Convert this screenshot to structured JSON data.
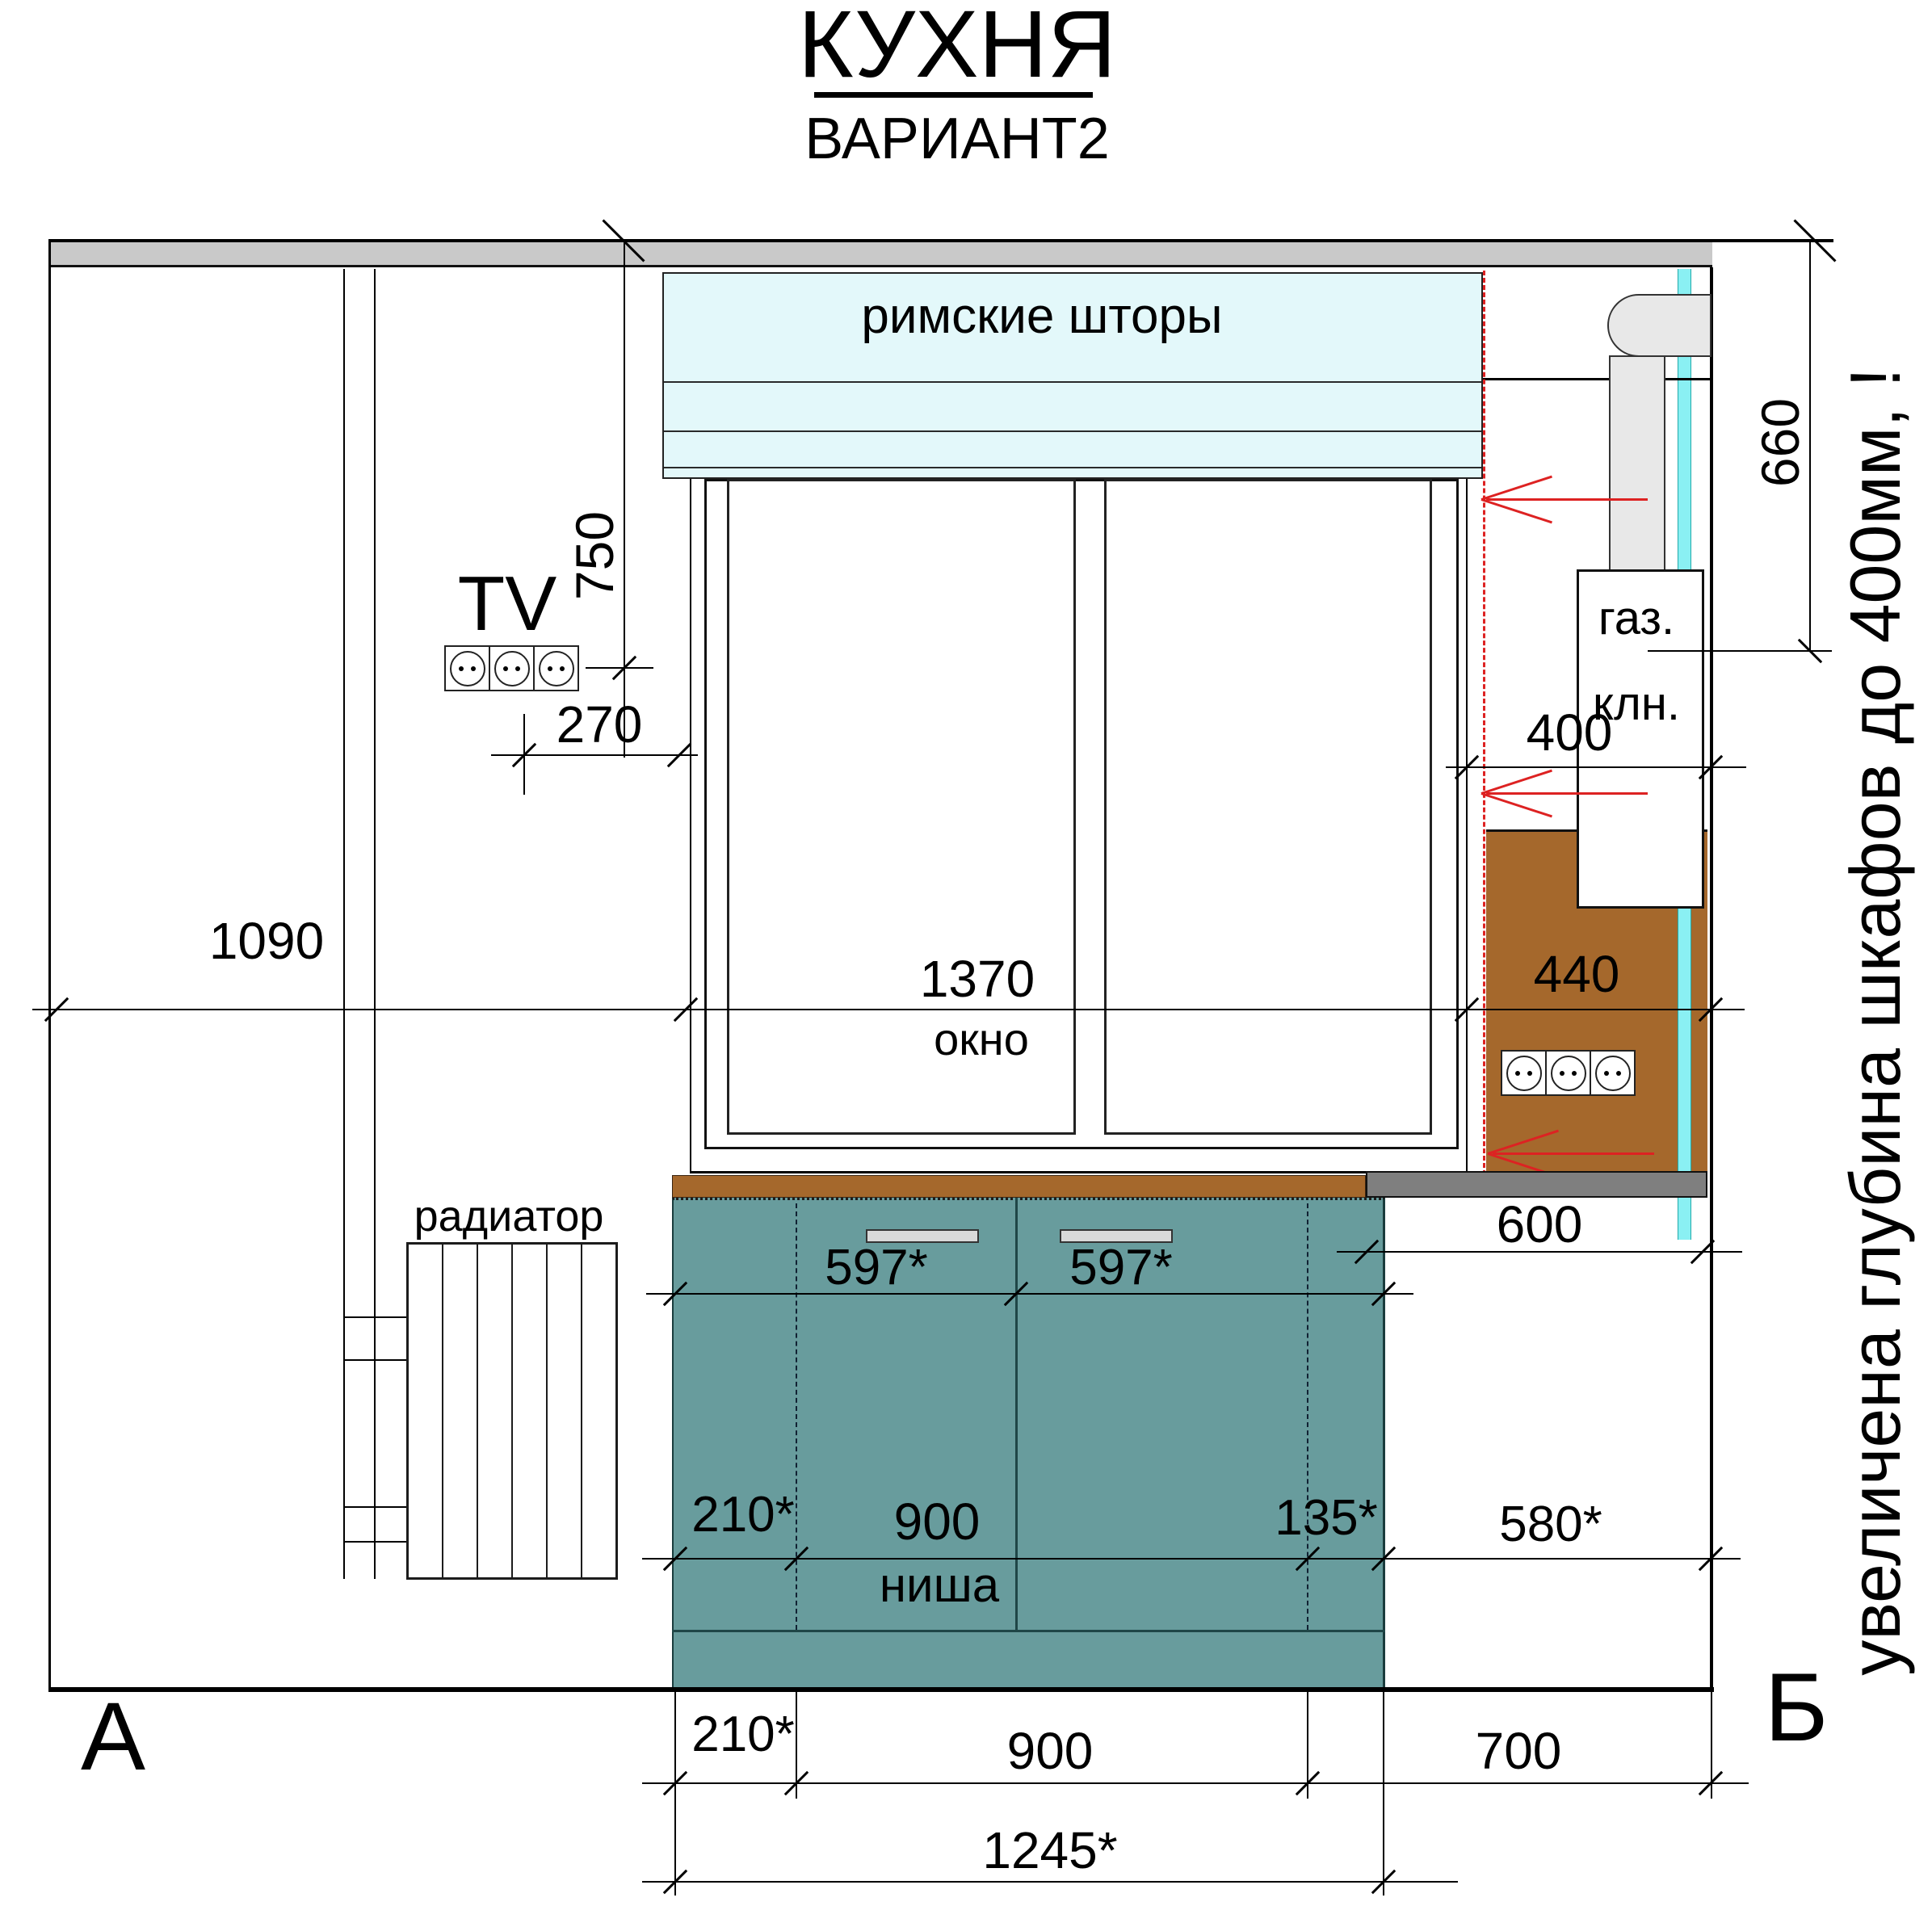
{
  "header": {
    "title": "КУХНЯ",
    "subtitle": "ВАРИАНТ2"
  },
  "labels": {
    "blind": "римские шторы",
    "tv": "TV",
    "radiator": "радиатор",
    "window": "окно",
    "gas_line1": "газ.",
    "gas_line2": "клн.",
    "niche": "ниша",
    "wall_mark_left": "А",
    "wall_mark_right": "Б",
    "note_rotated": "увеличена глубина шкафов до 400мм, !"
  },
  "dimensions": {
    "ceiling_to_tv": "750",
    "tv_to_window": "270",
    "wall_to_cabinet": "1090",
    "window_width": "1370",
    "window_to_wall": "440",
    "upper_zone_width": "400",
    "gas_column_height": "660",
    "door_left": "597*",
    "door_right": "597*",
    "counter_right": "600",
    "niche_offset_left": "210*",
    "niche_width": "900",
    "niche_offset_right": "135*",
    "right_gap": "580*",
    "base_offset_left": "210*",
    "base_niche": "900",
    "base_right": "700",
    "base_total": "1245*"
  },
  "colors": {
    "teal": "#689c9d",
    "brown": "#a5682c",
    "band": "#c9c9c9",
    "stripgray": "#7f7f7f",
    "duct": "#e8e8e8",
    "blind": "#e3f8fa",
    "cyan": "#8af0f3",
    "handle": "#d9d9d9",
    "red": "#dd2222"
  }
}
